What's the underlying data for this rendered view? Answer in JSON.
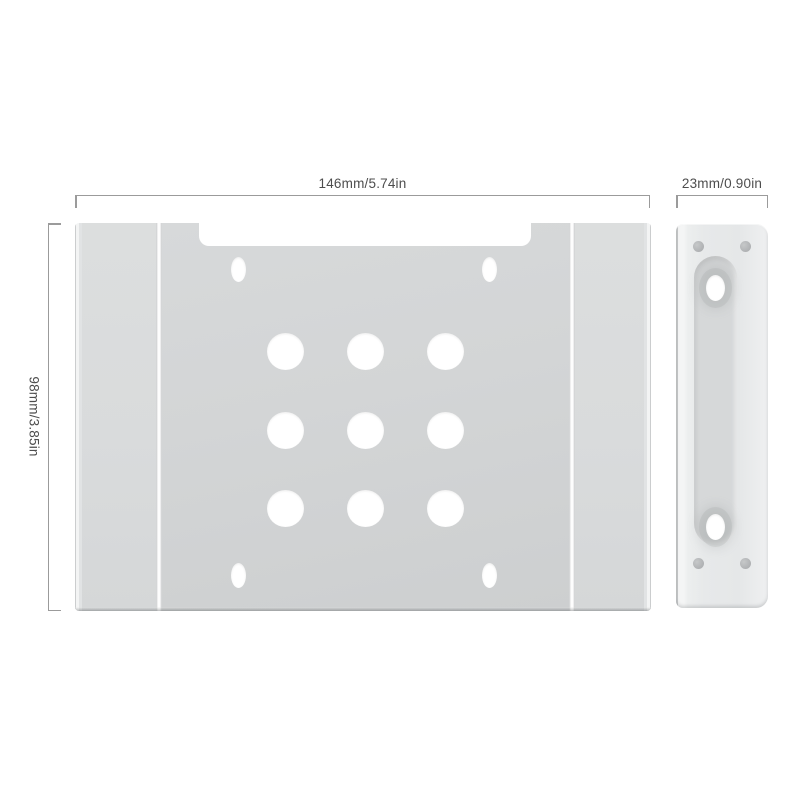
{
  "annotations": {
    "width_label": "146mm/5.74in",
    "height_label": "98mm/3.85in",
    "depth_label": "23mm/0.90in"
  },
  "top_view": {
    "large_holes": 9,
    "oval_slots": 4
  },
  "side_view": {
    "oval_screw_holes": 2,
    "rivets": 4
  },
  "colors": {
    "background": "#ffffff",
    "dimension_line": "#9b9b9b",
    "dimension_text": "#4d4d4d",
    "metal_plate": "#d3d5d6",
    "metal_rail": "#d9dbdc",
    "metal_side_panel": "#e7e9ea",
    "recess": "#d6d8d9",
    "hole": "#ffffff",
    "rivet": "#b1b3b5"
  }
}
